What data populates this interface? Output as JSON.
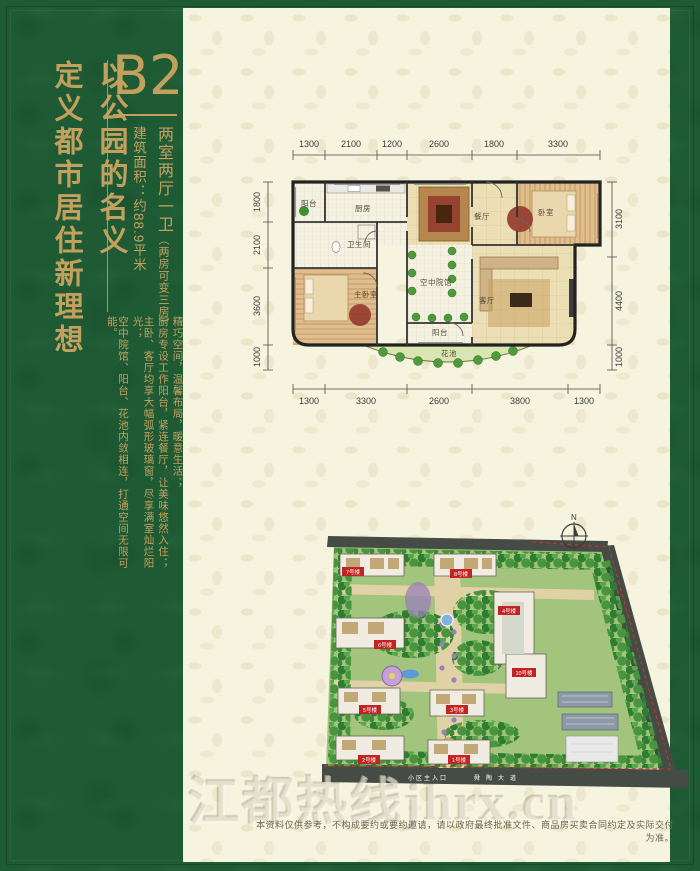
{
  "page": {
    "bg_green": "#1e5b34",
    "panel_cream": "#f6f3de",
    "accent_gold": "#c4a05f"
  },
  "left_panel": {
    "slogan_line1": "以公园的名义",
    "slogan_line2": "定义都市居住新理想",
    "unit_label": "B2",
    "unit_type": "两室两厅一卫",
    "unit_type_note": "（两房可变三房）",
    "area_text": "建筑面积：约88.9平米",
    "description_cols": [
      "精巧空间，温馨布局，暖意生活；",
      "厨房专设工作阳台，紧连餐厅，让美味悠然入住；",
      "主卧、客厅均享大幅弧形玻璃窗，尽享满室灿烂阳光；",
      "空中院馆、阳台、花池内敛相连，打通空间无限可能。"
    ]
  },
  "floorplan": {
    "dims_top": [
      "1300",
      "2100",
      "1200",
      "2600",
      "1800",
      "3300"
    ],
    "dims_bottom": [
      "1300",
      "3300",
      "2600",
      "3800",
      "1300"
    ],
    "dims_left": [
      "1800",
      "2100",
      "3600",
      "1000"
    ],
    "dims_right": [
      "3100",
      "4400",
      "1000"
    ],
    "rooms": {
      "balcony_top": "阳台",
      "kitchen": "厨房",
      "bath": "卫生间",
      "dining": "餐厅",
      "bedroom": "卧室",
      "master": "主卧室",
      "courtyard": "空中院馆",
      "living": "客厅",
      "balcony_bottom": "阳台",
      "flowerbed": "花池"
    }
  },
  "siteplan": {
    "compass": "N",
    "buildings": [
      "7号楼",
      "8号楼",
      "4号楼",
      "6号楼",
      "10号楼",
      "5号楼",
      "3号楼",
      "2号楼",
      "1号楼"
    ],
    "road_entrance": "小区主入口",
    "road_name": "舜陶大道"
  },
  "watermark": "江都热线jhrx.cn",
  "disclaimer": "本资料仅供参考，不构成要约或要约邀请，请以政府最终批准文件、商品房买卖合同约定及实际交付为准。"
}
